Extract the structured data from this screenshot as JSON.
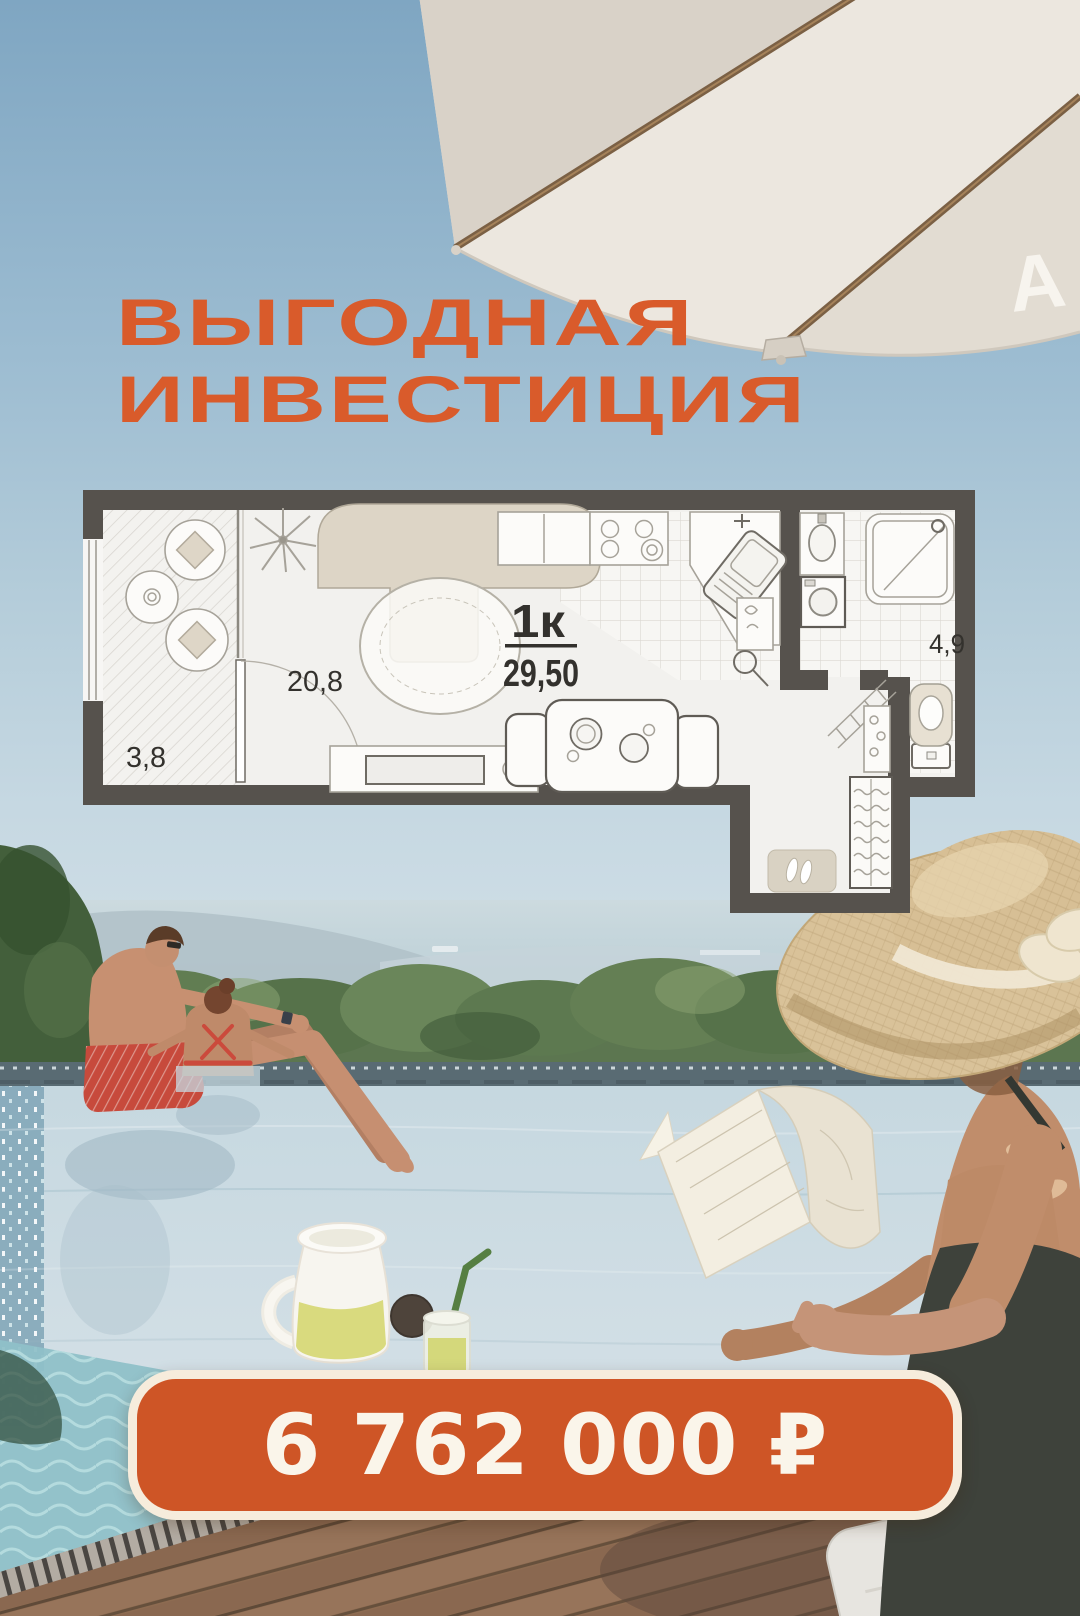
{
  "headline": {
    "line1": "ВЫГОДНАЯ",
    "line2": "ИНВЕСТИЦИЯ"
  },
  "umbrella": {
    "logo_letter": "А"
  },
  "floor_plan": {
    "type_label": "1к",
    "total_area_label": "29,50",
    "rooms": [
      {
        "name": "living-room",
        "area_label": "20,8"
      },
      {
        "name": "balcony",
        "area_label": "3,8"
      },
      {
        "name": "bathroom",
        "area_label": "4,9"
      }
    ]
  },
  "price_badge": {
    "text": "6 762 000 ₽"
  },
  "colors": {
    "accent_orange": "#d95b2b",
    "badge_fill": "#ce5526",
    "badge_border": "#f6ecdc",
    "plan_wall": "#56524d",
    "pool_water": "#c6d8e0",
    "straw_hat": "#d9c299"
  }
}
